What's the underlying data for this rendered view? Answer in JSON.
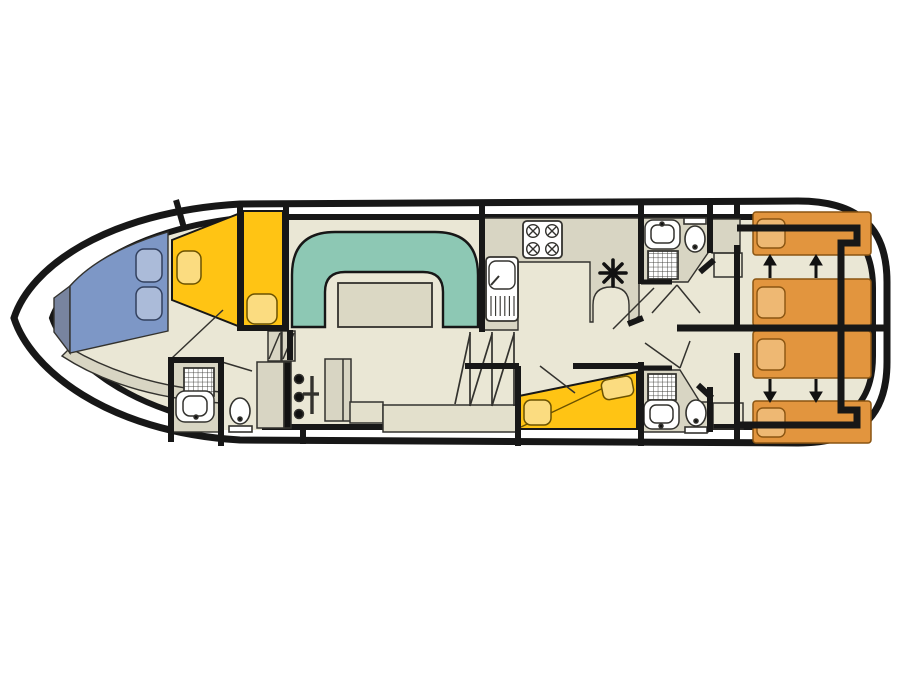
{
  "colors": {
    "bg": "#ffffff",
    "line": "#171717",
    "thin": "#33322e",
    "floor": "#eae7d5",
    "floor_dark": "#d8d5c3",
    "furniture": "#e3e0cc",
    "teal": "#8dc8b4",
    "table": "#dbd8c4",
    "yellow": "#ffc414",
    "yellow_light": "#fbdc80",
    "yellow_edge": "#6b5200",
    "blue": "#7d97c6",
    "blue_light": "#abbbd9",
    "blue_dark": "#78849f",
    "blue_edge": "#32405e",
    "orange": "#e2953e",
    "orange_light": "#eeb873",
    "orange_edge": "#8a5512",
    "white": "#ffffff",
    "black": "#111111"
  }
}
